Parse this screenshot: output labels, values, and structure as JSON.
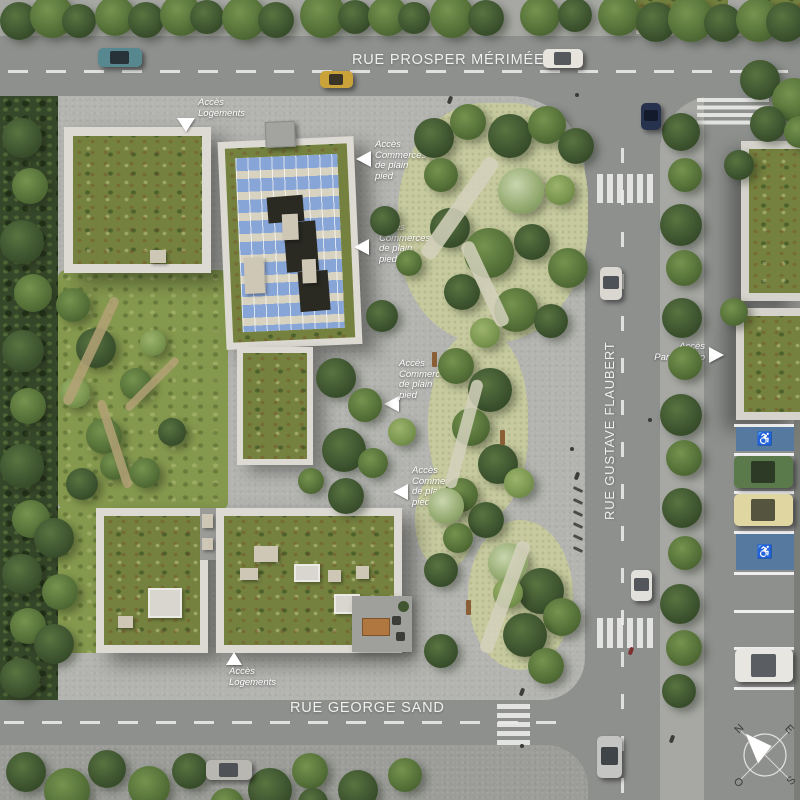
{
  "title": "Plan masse aérien du projet",
  "streets": {
    "top": "RUE PROSPER MÉRIMÉE",
    "right": "RUE GUSTAVE FLAUBERT",
    "bottom": "RUE GEORGE SAND"
  },
  "annotations": [
    {
      "id": "acces-logements-nord",
      "text": "Accès\nLogements",
      "arrow": "down"
    },
    {
      "id": "acces-commerces-1",
      "text": "Accès\nCommerces\nde plain\npied",
      "arrow": "left"
    },
    {
      "id": "acces-commerces-2",
      "text": "Accès\nCommerces\nde plain\npied",
      "arrow": "left"
    },
    {
      "id": "acces-commerces-3",
      "text": "Accès\nCommerces\nde plain\npied",
      "arrow": "left"
    },
    {
      "id": "acces-commerces-4",
      "text": "Accès\nCommerces\nde plain\npied",
      "arrow": "left"
    },
    {
      "id": "acces-parking-silo",
      "text": "Accès\nParking Silo",
      "arrow": "right"
    },
    {
      "id": "acces-logements-sud",
      "text": "Accès\nLogements",
      "arrow": "up"
    }
  ],
  "compass": {
    "north": "N",
    "east": "E",
    "south": "S",
    "west": "O"
  },
  "icons": {
    "handicap": "♿"
  },
  "colors": {
    "road": "#8e908e",
    "plaza": "#b3b4b0",
    "green_roof": "#75823f",
    "solar_panel": "#87a5d6",
    "handicap_spot": "#56799f",
    "lawn": "#85994e",
    "label_white": "#ffffff"
  }
}
